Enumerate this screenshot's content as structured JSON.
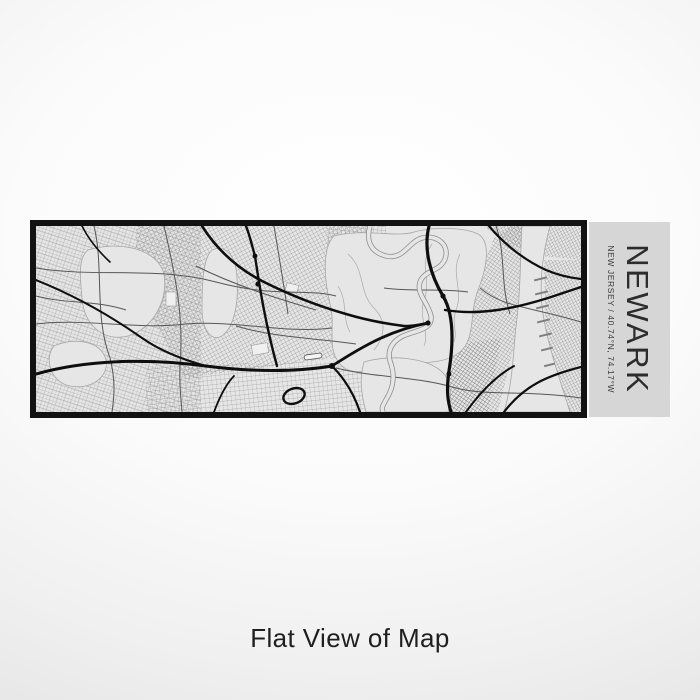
{
  "label_panel": {
    "title": "NEWARK",
    "subtitle": "NEW JERSEY / 40.74°N, 74.17°W"
  },
  "page": {
    "caption": "Flat View of Map"
  },
  "colors": {
    "background_outer": "#e2e2e2",
    "background_center": "#ffffff",
    "map_bg": "#e6e6e6",
    "map_border": "#121212",
    "panel_bg": "#d6d6d6",
    "ink": "#1f1f1f",
    "street": "#8f8f8f",
    "highway": "#0e0e0e"
  }
}
